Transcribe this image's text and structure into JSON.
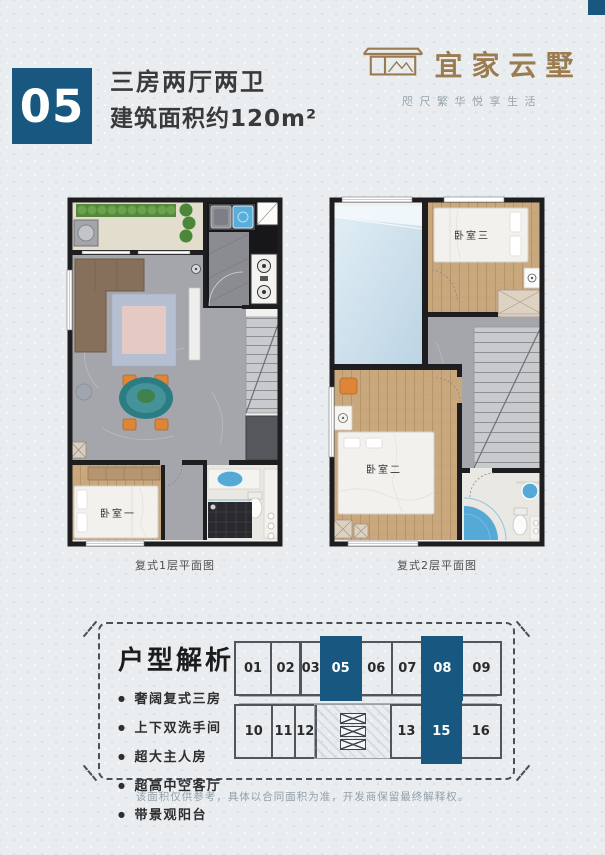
{
  "header": {
    "unit_number": "05",
    "title": "三房两厅两卫",
    "subtitle": "建筑面积约120m²"
  },
  "brand": {
    "name": "宜家云墅",
    "tagline": "咫尺繁华悦享生活"
  },
  "floorplans": {
    "plan1": {
      "caption": "复式1层平面图",
      "labels": {
        "bedroom1": "卧室一"
      }
    },
    "plan2": {
      "caption": "复式2层平面图",
      "labels": {
        "bedroom2": "卧室二",
        "bedroom3": "卧室三"
      }
    }
  },
  "analysis": {
    "heading": "户型解析",
    "bullets": [
      "奢阔复式三房",
      "上下双洗手间",
      "超大主人房",
      "超高中空客厅",
      "带景观阳台"
    ]
  },
  "keyplan": {
    "rows": [
      {
        "units": [
          {
            "label": "01",
            "highlighted": false,
            "flex": 34
          },
          {
            "label": "02",
            "highlighted": false,
            "flex": 28
          },
          {
            "label": "03",
            "highlighted": false,
            "flex": 19
          },
          {
            "label": "05",
            "highlighted": true,
            "flex": 38
          },
          {
            "label": "06",
            "highlighted": false,
            "flex": 30
          },
          {
            "label": "07",
            "highlighted": false,
            "flex": 29
          },
          {
            "label": "08",
            "highlighted": true,
            "flex": 38
          },
          {
            "label": "09",
            "highlighted": false,
            "flex": 37
          }
        ]
      },
      {
        "units": [
          {
            "label": "10",
            "highlighted": false,
            "flex": 35
          },
          {
            "label": "11",
            "highlighted": false,
            "flex": 21
          },
          {
            "label": "12",
            "highlighted": false,
            "flex": 19
          },
          {
            "label": "",
            "core": true,
            "highlighted": false,
            "flex": 75
          },
          {
            "label": "13",
            "highlighted": false,
            "flex": 29
          },
          {
            "label": "15",
            "highlighted": true,
            "flex": 37
          },
          {
            "label": "16",
            "highlighted": false,
            "flex": 38
          }
        ]
      }
    ]
  },
  "disclaimer": "该面积仅供参考，具体以合同面积为准，开发商保留最终解释权。",
  "colors": {
    "accent": "#175780",
    "brand_gold": "#9b7c50"
  }
}
